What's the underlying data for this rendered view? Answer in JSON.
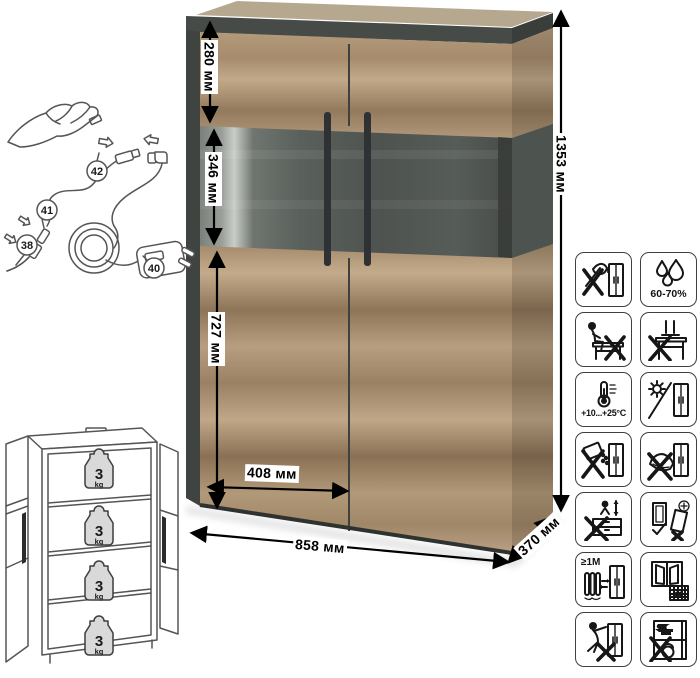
{
  "sheet": {
    "kind": "furniture-dimension-sheet",
    "background": "#ffffff"
  },
  "dimensions": {
    "top_section_height": "280 мм",
    "glass_section_height": "346 мм",
    "bottom_section_height": "727 мм",
    "door_width": "408 мм",
    "total_width": "858 мм",
    "depth": "370 мм",
    "total_height": "1353 мм"
  },
  "assembly": {
    "part_labels": [
      "38",
      "40",
      "41",
      "42"
    ]
  },
  "load_limits": {
    "shelves": [
      {
        "value": "3",
        "unit": "kg"
      },
      {
        "value": "3",
        "unit": "kg"
      },
      {
        "value": "3",
        "unit": "kg"
      },
      {
        "value": "3",
        "unit": "kg"
      }
    ]
  },
  "care_icons": [
    {
      "name": "no-sharp-tools",
      "label": ""
    },
    {
      "name": "humidity-range",
      "label": "60-70%"
    },
    {
      "name": "no-sitting-on-furniture",
      "label": ""
    },
    {
      "name": "no-standing-on-furniture",
      "label": ""
    },
    {
      "name": "temperature-range",
      "label": "+10...+25°C"
    },
    {
      "name": "no-direct-sunlight",
      "label": ""
    },
    {
      "name": "no-liquids",
      "label": ""
    },
    {
      "name": "no-kicking",
      "label": ""
    },
    {
      "name": "no-jumping-on-furniture",
      "label": ""
    },
    {
      "name": "door-adjustment",
      "label": ""
    },
    {
      "name": "heat-source-distance",
      "label": "≥1M"
    },
    {
      "name": "ventilate-room",
      "label": "21"
    },
    {
      "name": "no-climbing-on-doors",
      "label": ""
    },
    {
      "name": "no-heavy-items-inside",
      "label": ""
    }
  ],
  "colors": {
    "wood_light": "#c1a98a",
    "wood_dark": "#8a7155",
    "graphite": "#474b48",
    "glass_panel": "#545a55",
    "annotation": "#000000",
    "background": "#ffffff"
  }
}
